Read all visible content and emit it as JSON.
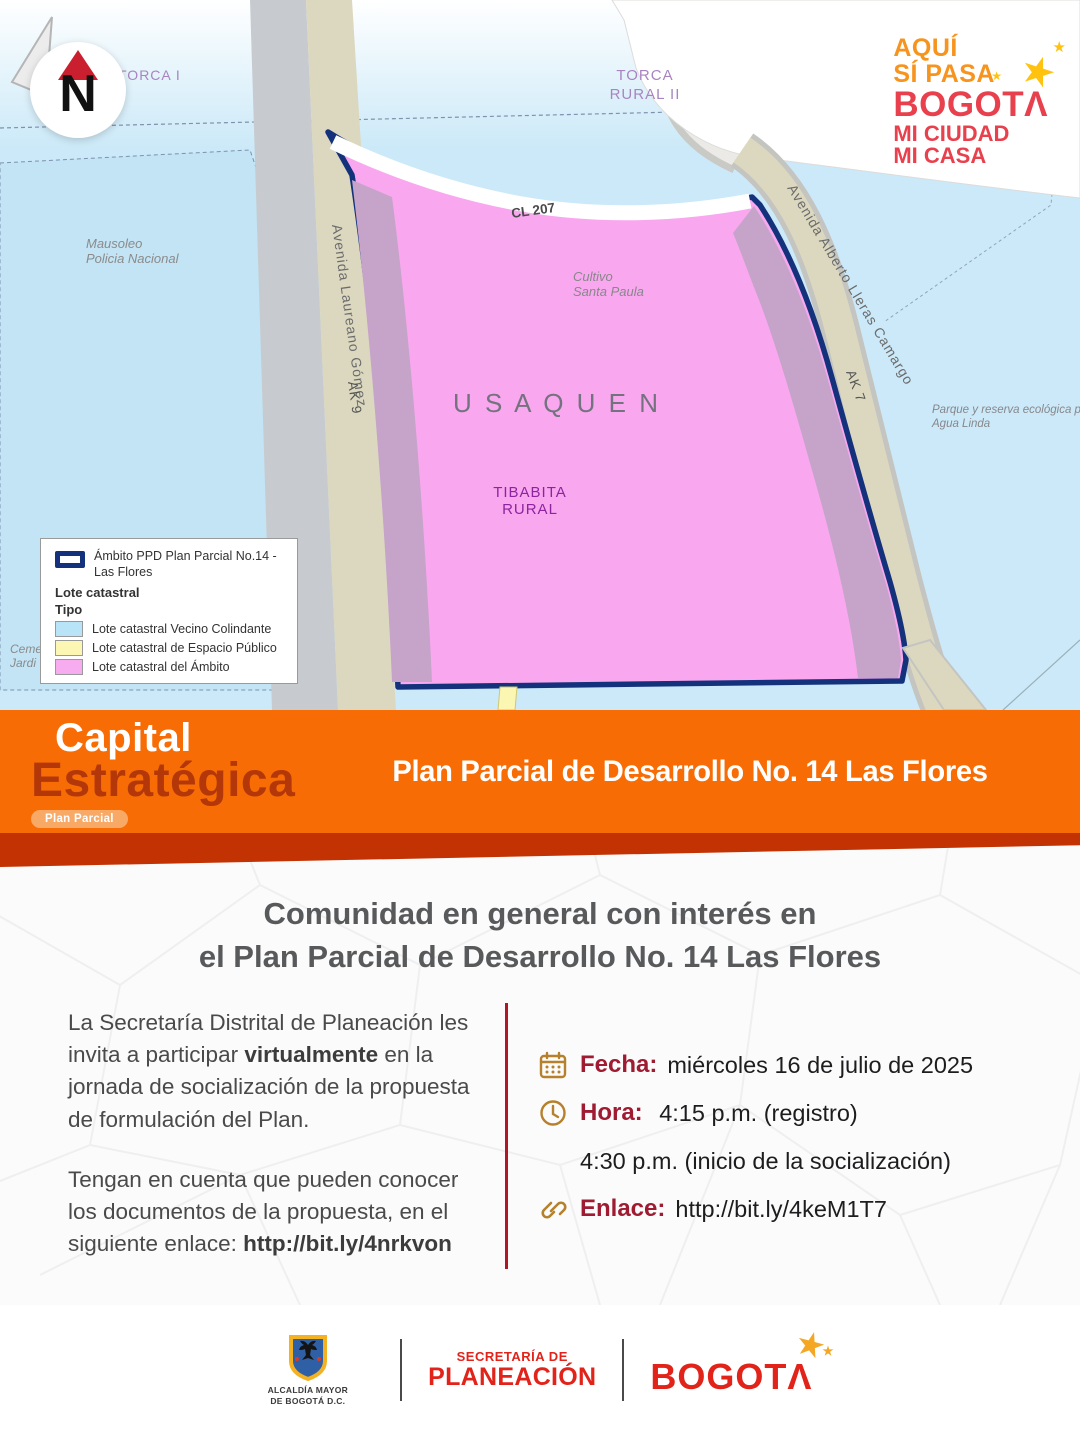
{
  "map": {
    "north_letter": "N",
    "labels": {
      "torca_i": "TORCA I",
      "torca_rural_1": "TORCA",
      "torca_rural_2": "RURAL II",
      "mausoleo_1": "Mausoleo",
      "mausoleo_2": "Policia Nacional",
      "cultivo_1": "Cultivo",
      "cultivo_2": "Santa Paula",
      "usaquen": "U S A Q U E N",
      "tibabita_1": "TIBABITA",
      "tibabita_2": "RURAL",
      "parque_1": "Parque y reserva ecológica priva",
      "parque_2": "Agua Linda",
      "cementerio_1": "Ceme",
      "cementerio_2": "Jardi"
    },
    "roads": {
      "cl207": "CL 207",
      "laureano": "Avenida Laureano Gómez",
      "ak9": "AK 9",
      "lleras": "Avenida Alberto Lleras Camargo",
      "ak7": "AK 7"
    }
  },
  "brand_badge": {
    "line1": "AQUÍ",
    "line2": "SÍ PASA",
    "line3": "BOGOTΛ",
    "line4": "MI CIUDAD",
    "line5": "MI CASA",
    "star": "★"
  },
  "legend": {
    "ambito_line1": "Ámbito PPD Plan Parcial No.14 -",
    "ambito_line2": "Las Flores",
    "lote_header": "Lote catastral",
    "tipo_header": "Tipo",
    "items": [
      {
        "label": "Lote catastral Vecino Colindante",
        "color": "#b9e3f6"
      },
      {
        "label": "Lote catastral de Espacio Público",
        "color": "#fbf6b2"
      },
      {
        "label": "Lote catastral del Ámbito",
        "color": "#f6acee"
      }
    ]
  },
  "banner": {
    "capital": "Capital",
    "estrategica": "Estratégica",
    "pill": "Plan Parcial",
    "title": "Plan Parcial de Desarrollo No. 14 Las Flores"
  },
  "content": {
    "title_line1": "Comunidad en general con interés en",
    "title_line2": "el Plan Parcial de Desarrollo No. 14 Las Flores",
    "p1_pre": "La Secretaría Distrital de Planeación les invita a participar ",
    "p1_bold": "virtualmente",
    "p1_post": " en la jornada de socialización de la propuesta de formulación del Plan.",
    "p2_pre": "Tengan en cuenta que pueden conocer los documentos de la propuesta, en el siguiente enlace: ",
    "p2_link": "http://bit.ly/4nrkvon",
    "details": [
      {
        "icon": "calendar-icon",
        "label": "Fecha:",
        "value": "miércoles 16 de julio de 2025"
      },
      {
        "icon": "clock-icon",
        "label": "Hora:",
        "value": " 4:15 p.m. (registro)"
      },
      {
        "icon": "",
        "label": "",
        "value": "4:30 p.m. (inicio de la socialización)"
      },
      {
        "icon": "link-icon",
        "label": "Enlace:",
        "value": "http://bit.ly/4keM1T7"
      }
    ]
  },
  "footer": {
    "alcaldia_line1": "ALCALDÍA MAYOR",
    "alcaldia_line2": "DE BOGOTÁ D.C.",
    "secretaria_line1": "SECRETARÍA DE",
    "secretaria_line2": "PLANEACIÓN",
    "bogota": "BOGOTΛ",
    "star": "★"
  },
  "colors": {
    "map_blue": "#cbe9f8",
    "ambito_pink": "#f9a8ef",
    "edge_mauve": "#c6a3c9",
    "boundary_navy": "#14327c",
    "road_tan": "#dcd8bf",
    "road_gray": "#c7cbcf",
    "banner_orange": "#f76c05",
    "strip_dark_red": "#c23203",
    "estrategica_red": "#b33708",
    "label_crimson": "#9e1b32",
    "divider_red": "#b01724",
    "icon_gold": "#b5812c",
    "footer_red": "#e2231a",
    "star_gold": "#f5a623"
  }
}
